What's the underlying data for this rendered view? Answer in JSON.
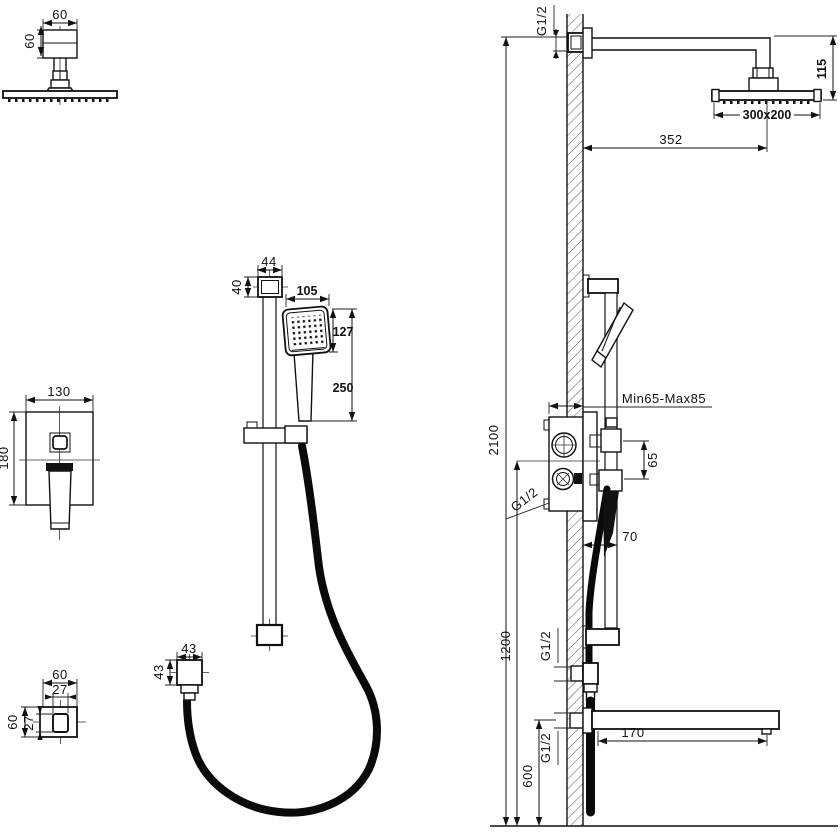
{
  "drawing": {
    "kind": "shower-system-installation-technical-drawing",
    "views": {
      "overhead_shower_front": {
        "width": "60",
        "depth": "60"
      },
      "mixer_front": {
        "width": "130",
        "height": "180"
      },
      "wall_outlet_front": {
        "width": "60",
        "inner_width": "27",
        "height": "60",
        "inner_height": "27"
      },
      "hand_shower_front": {
        "bracket_width": "44",
        "bracket_depth": "40",
        "head_width": "105",
        "head_length": "127",
        "total_length": "250",
        "connector_width": "43",
        "connector_height": "43"
      },
      "installation_side": {
        "inlet_thread": "G1/2",
        "head_drop": "115",
        "head_size": "300x200",
        "arm_reach": "352",
        "total_height": "2100",
        "valve_depth_range": "Min65-Max85",
        "diverter_spacing": "65",
        "valve_thread": "G1/2",
        "bar_offset": "70",
        "valve_height": "1200",
        "outlet_thread": "G1/2",
        "spout_height": "600",
        "spout_thread": "G1/2",
        "spout_reach": "170"
      }
    }
  }
}
